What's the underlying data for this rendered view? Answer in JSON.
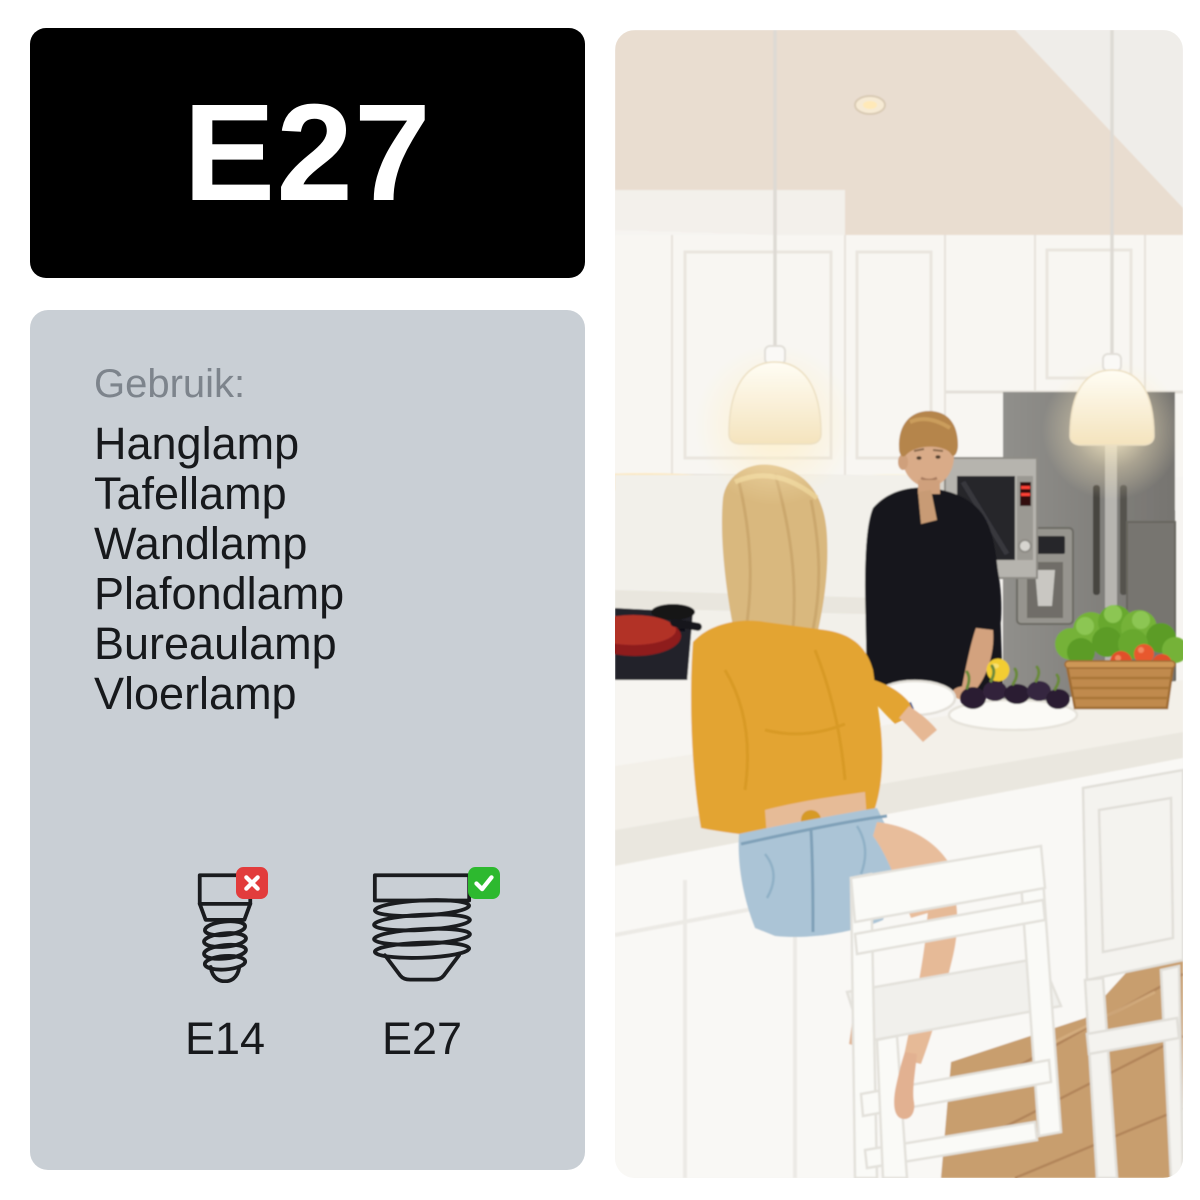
{
  "socket_badge": {
    "label": "E27",
    "bg": "#000000",
    "text_color": "#ffffff"
  },
  "info_panel": {
    "panel_bg": "#c9cfd5",
    "usage_title": "Gebruik:",
    "usage_items": [
      "Hanglamp",
      "Tafellamp",
      "Wandlamp",
      "Plafondlamp",
      "Bureaulamp",
      "Vloerlamp"
    ],
    "fittings": [
      {
        "label": "E14",
        "status": "incompatible",
        "badge_icon": "cross-icon",
        "badge_color": "#e23c3c"
      },
      {
        "label": "E27",
        "status": "compatible",
        "badge_icon": "check-icon",
        "badge_color": "#2db92f"
      }
    ]
  },
  "photo": {
    "alt": "couple talking in a white kitchen with two glowing E27 pendant lamps"
  }
}
